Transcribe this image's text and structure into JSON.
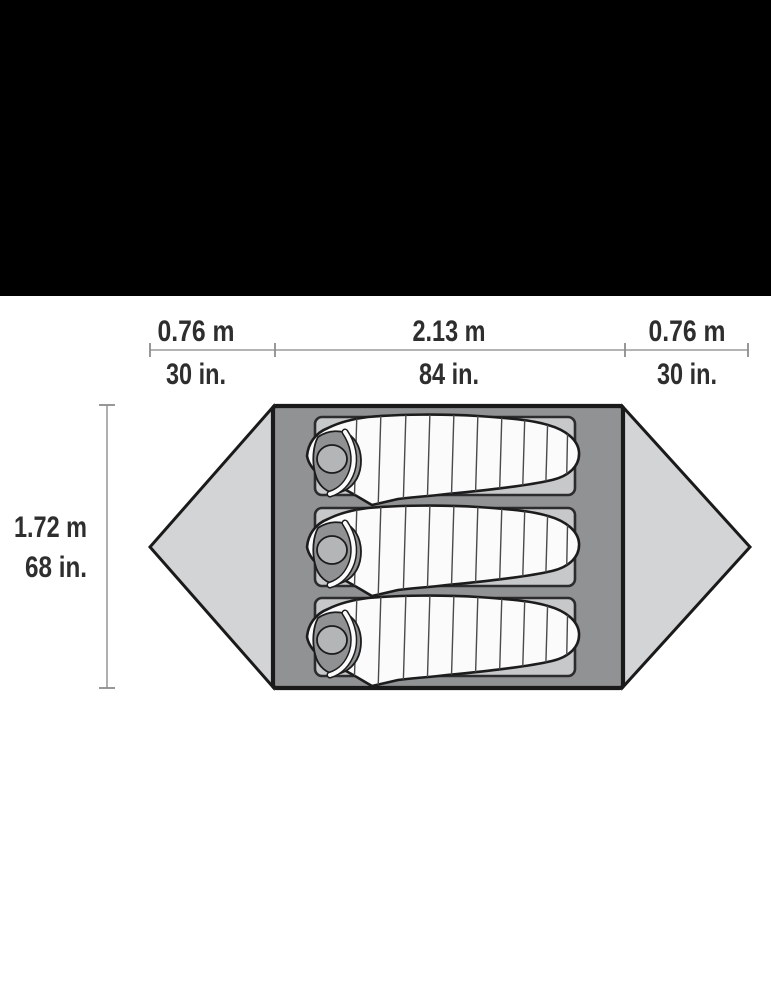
{
  "header_bar": {
    "color": "#000000"
  },
  "dimensions": {
    "top": [
      {
        "metric": "0.76 m",
        "imperial": "30 in."
      },
      {
        "metric": "2.13 m",
        "imperial": "84 in."
      },
      {
        "metric": "0.76 m",
        "imperial": "30 in."
      }
    ],
    "side": {
      "metric": "1.72 m",
      "imperial": "68 in."
    }
  },
  "tent": {
    "floor_fill": "#909294",
    "vestibule_fill": "#d3d4d6",
    "pad_fill": "#c6c8ca",
    "bag_fill": "#fbfbfb",
    "hood_inner_fill": "#8f9193",
    "head_fill": "#b3b5b7",
    "outline_color": "#1a1a1a",
    "sleeping_pad_count": "3",
    "sleeping_bag_count": "3",
    "vestibule_count": "2"
  },
  "text_color": "#2e2e2e",
  "dimension_line_color": "#9b9b9b"
}
